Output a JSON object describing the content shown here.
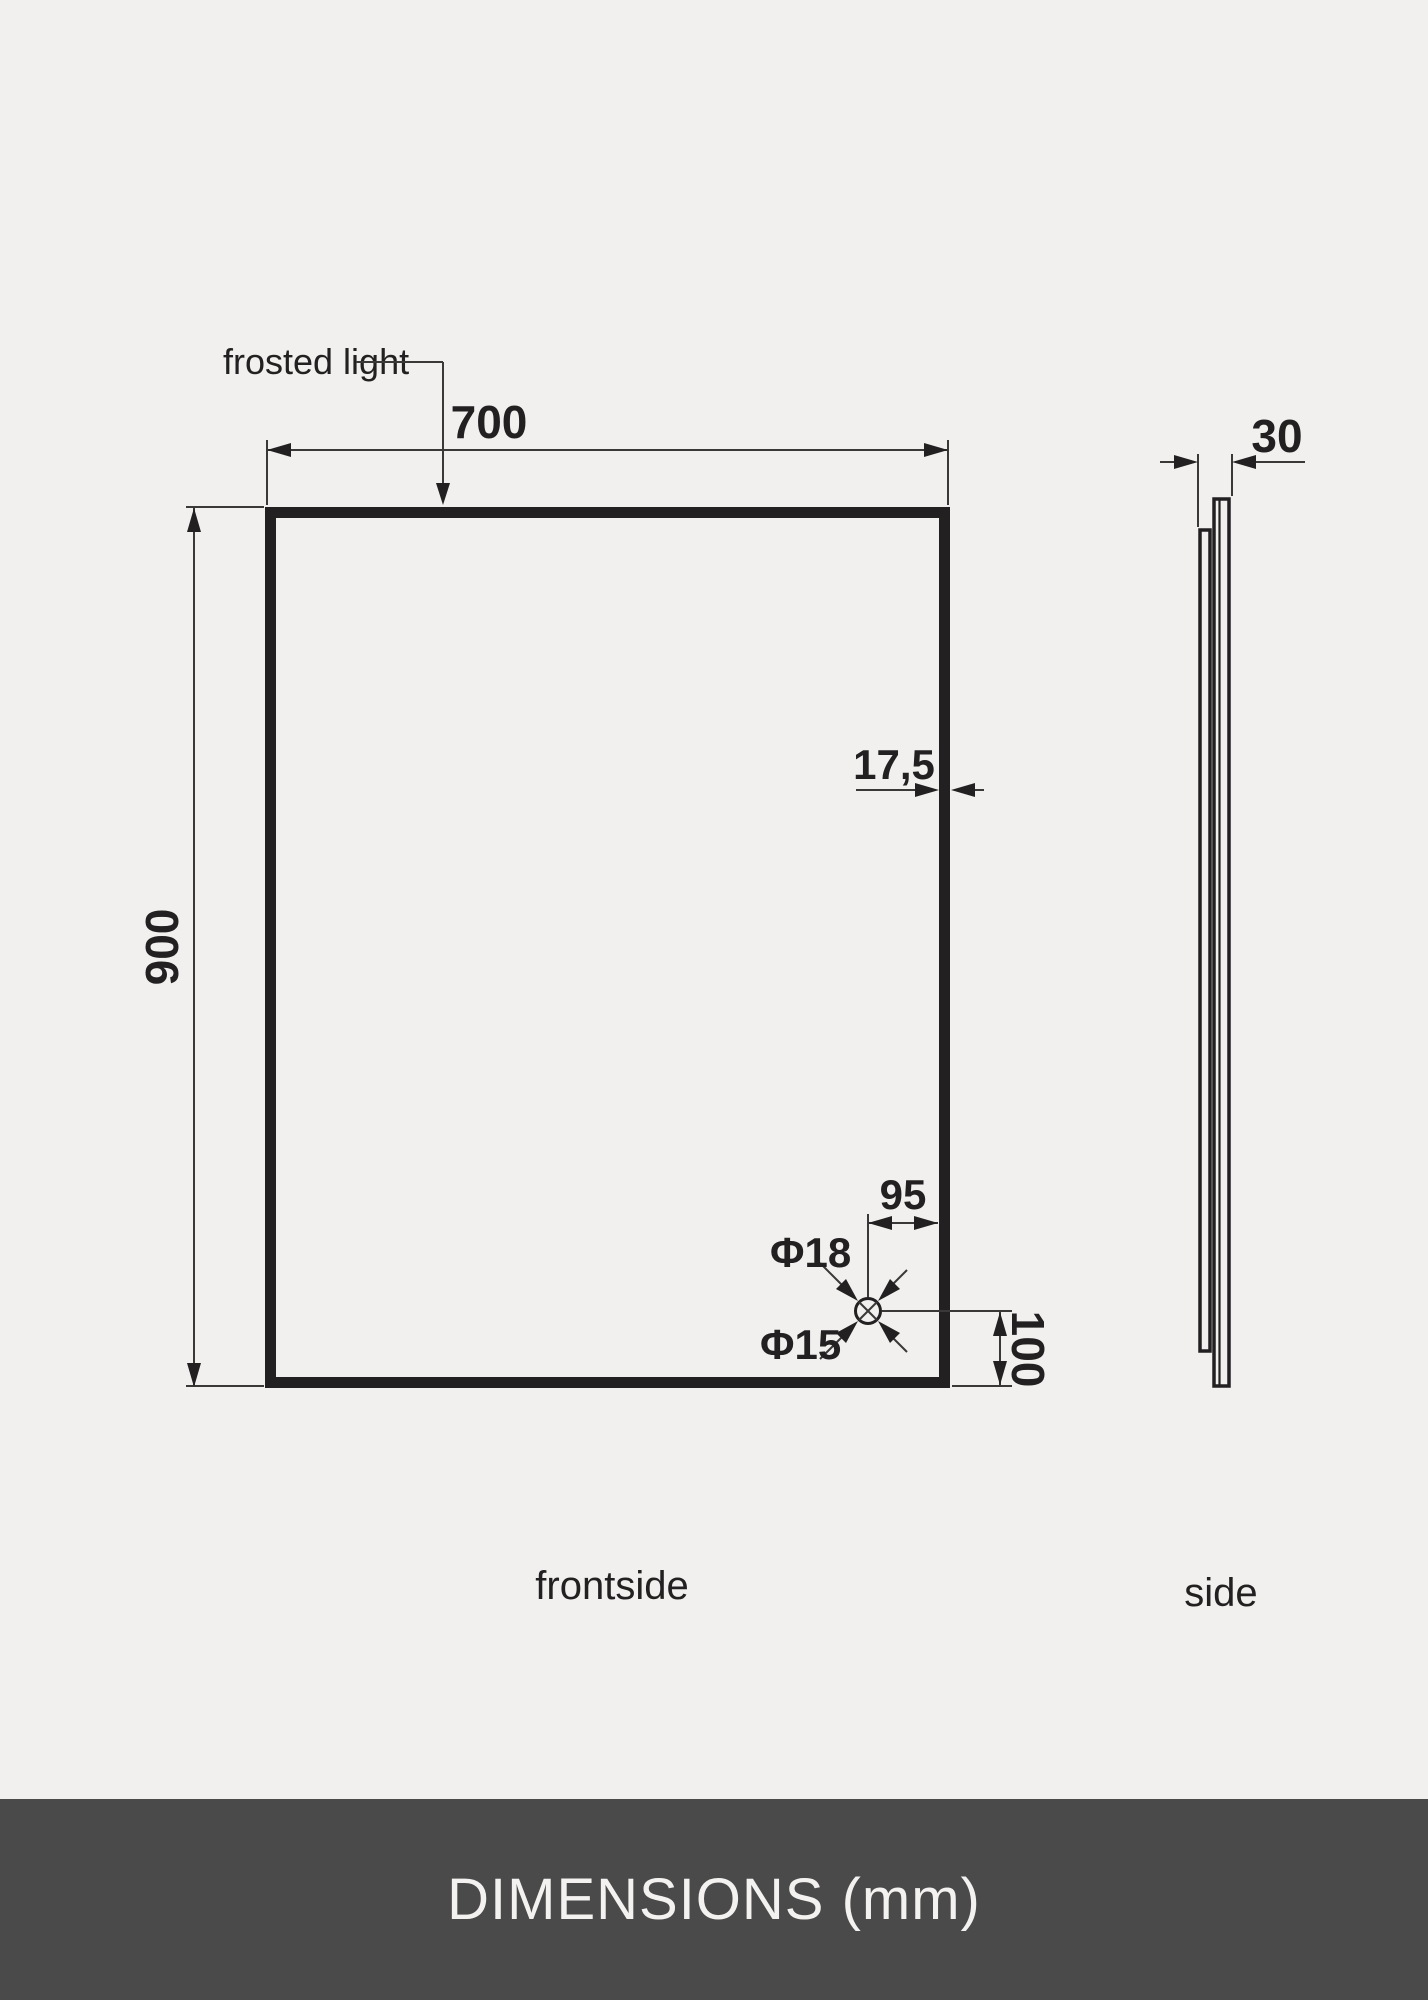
{
  "drawing": {
    "annotation_label": "frosted light",
    "front_view": {
      "caption": "frontside",
      "width_mm": "700",
      "height_mm": "900",
      "frame_thickness_mm": "17,5",
      "hole_offset_x_mm": "95",
      "hole_offset_y_mm": "100",
      "hole_outer_diameter": "Φ18",
      "hole_inner_diameter": "Φ15"
    },
    "side_view": {
      "caption": "side",
      "depth_mm": "30"
    }
  },
  "footer": {
    "title": "DIMENSIONS (mm)"
  },
  "colors": {
    "background": "#f1f0ee",
    "line": "#232021",
    "thin_line": "#3a3938",
    "footer_background": "#4b4a4a",
    "footer_text": "#f3f2f0"
  }
}
